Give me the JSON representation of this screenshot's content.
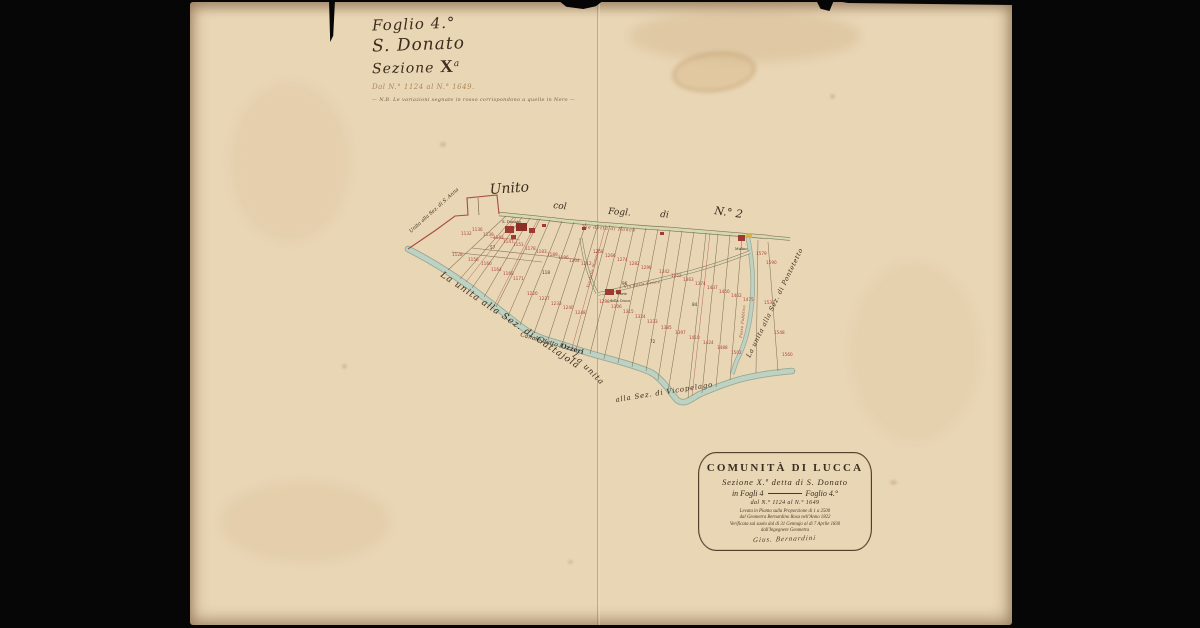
{
  "colors": {
    "background": "#060606",
    "paper": "#e9d6b5",
    "ink": "#3c2c1d",
    "parcel_red": "#b0443a",
    "canal_blue_green": "#b7cfc0",
    "road_green": "#cfd8ad"
  },
  "title_block": {
    "line1": "Foglio 4.°",
    "line2": "S. Donato",
    "line3_word": "Sezione",
    "line3_symbol": "X",
    "line3_sup": "a",
    "line4": "Dal N.° 1124 al N.° 1649.",
    "line5": "— N.B. Le variazioni segnate in rosso corrispondono a quelle in Nero —"
  },
  "map": {
    "labels": {
      "unito": "Unito",
      "col": "col",
      "fogl": "Fogl.",
      "di": "di",
      "n2": "N.° 2",
      "via_ronco": "Via detta di Ronco",
      "via_croce": "Via della Croce",
      "via_monache": "Via delle Monache",
      "canale_a": "Canale detto l'",
      "canale_b": "Ozzeri",
      "sez_sanna": "Unita alla Sez. di S. Anna",
      "sez_gattajola": "La unita alla Sez. di Gattajola",
      "sez_vicopelago_a": "La unita",
      "sez_vicopelago_b": "alla Sez. di Vicopelago",
      "sez_pontetetto": "La unita alla Sez. di Pontetetto",
      "fosso": "Fosso Pubblico",
      "village": "S. Donato",
      "corte_a": "Corte",
      "corte_b": "della Croce",
      "mulino": "Mulino"
    },
    "parcel_numbers": [
      {
        "x": 271,
        "y": 233,
        "n": "1132"
      },
      {
        "x": 282,
        "y": 229,
        "n": "1136"
      },
      {
        "x": 293,
        "y": 234,
        "n": "1139"
      },
      {
        "x": 303,
        "y": 237,
        "n": "1143"
      },
      {
        "x": 313,
        "y": 241,
        "n": "1147"
      },
      {
        "x": 323,
        "y": 244,
        "n": "1151"
      },
      {
        "x": 262,
        "y": 254,
        "n": "1128"
      },
      {
        "x": 278,
        "y": 259,
        "n": "1156"
      },
      {
        "x": 291,
        "y": 263,
        "n": "1160"
      },
      {
        "x": 301,
        "y": 269,
        "n": "1164"
      },
      {
        "x": 313,
        "y": 273,
        "n": "1168"
      },
      {
        "x": 323,
        "y": 278,
        "n": "1171"
      },
      {
        "x": 335,
        "y": 248,
        "n": "1178"
      },
      {
        "x": 346,
        "y": 251,
        "n": "1183"
      },
      {
        "x": 357,
        "y": 254,
        "n": "1189"
      },
      {
        "x": 368,
        "y": 257,
        "n": "1196"
      },
      {
        "x": 379,
        "y": 260,
        "n": "1204"
      },
      {
        "x": 391,
        "y": 263,
        "n": "1212"
      },
      {
        "x": 337,
        "y": 293,
        "n": "1220"
      },
      {
        "x": 349,
        "y": 298,
        "n": "1227"
      },
      {
        "x": 361,
        "y": 303,
        "n": "1233"
      },
      {
        "x": 373,
        "y": 307,
        "n": "1240"
      },
      {
        "x": 385,
        "y": 312,
        "n": "1248"
      },
      {
        "x": 403,
        "y": 251,
        "n": "1258"
      },
      {
        "x": 415,
        "y": 255,
        "n": "1266"
      },
      {
        "x": 427,
        "y": 259,
        "n": "1274"
      },
      {
        "x": 439,
        "y": 263,
        "n": "1282"
      },
      {
        "x": 451,
        "y": 267,
        "n": "1290"
      },
      {
        "x": 409,
        "y": 301,
        "n": "1298"
      },
      {
        "x": 421,
        "y": 306,
        "n": "1306"
      },
      {
        "x": 433,
        "y": 311,
        "n": "1315"
      },
      {
        "x": 445,
        "y": 316,
        "n": "1324"
      },
      {
        "x": 457,
        "y": 321,
        "n": "1333"
      },
      {
        "x": 469,
        "y": 271,
        "n": "1342"
      },
      {
        "x": 481,
        "y": 275,
        "n": "1352"
      },
      {
        "x": 493,
        "y": 279,
        "n": "1363"
      },
      {
        "x": 505,
        "y": 283,
        "n": "1374"
      },
      {
        "x": 471,
        "y": 327,
        "n": "1385"
      },
      {
        "x": 485,
        "y": 332,
        "n": "1397"
      },
      {
        "x": 499,
        "y": 337,
        "n": "1410"
      },
      {
        "x": 513,
        "y": 342,
        "n": "1424"
      },
      {
        "x": 517,
        "y": 287,
        "n": "1437"
      },
      {
        "x": 529,
        "y": 291,
        "n": "1450"
      },
      {
        "x": 541,
        "y": 295,
        "n": "1462"
      },
      {
        "x": 553,
        "y": 299,
        "n": "1475"
      },
      {
        "x": 527,
        "y": 347,
        "n": "1488"
      },
      {
        "x": 541,
        "y": 352,
        "n": "1502"
      },
      {
        "x": 566,
        "y": 253,
        "n": "1579"
      },
      {
        "x": 576,
        "y": 262,
        "n": "1590"
      },
      {
        "x": 574,
        "y": 302,
        "n": "1533"
      },
      {
        "x": 584,
        "y": 332,
        "n": "1548"
      },
      {
        "x": 592,
        "y": 354,
        "n": "1560"
      },
      {
        "x": 352,
        "y": 272,
        "n": "118",
        "k": 1
      },
      {
        "x": 432,
        "y": 283,
        "n": "96",
        "k": 1
      },
      {
        "x": 502,
        "y": 304,
        "n": "84",
        "k": 1
      },
      {
        "x": 300,
        "y": 247,
        "n": "57",
        "k": 1
      },
      {
        "x": 460,
        "y": 341,
        "n": "72",
        "k": 1
      }
    ]
  },
  "cartouche": {
    "title": "COMUNITÀ DI LUCCA",
    "line2": "Sezione X.ª detta di S. Donato",
    "line3_a": "in Fogli 4",
    "line3_b": "Foglio 4.°",
    "line4": "dal N.° 1124 al N.° 1649",
    "line5": "Levata in Pianta sulla Proporzione di 1 a 2500",
    "line6": "dal Geometra Bernardino Rosa nell'Anno 1822",
    "line7": "Verificata sul suolo dal dì 31 Gennajo al dì 7 Aprile 1830",
    "line8": "dall'Ingegnere Geometra",
    "signature": "Gius. Bernardini"
  }
}
